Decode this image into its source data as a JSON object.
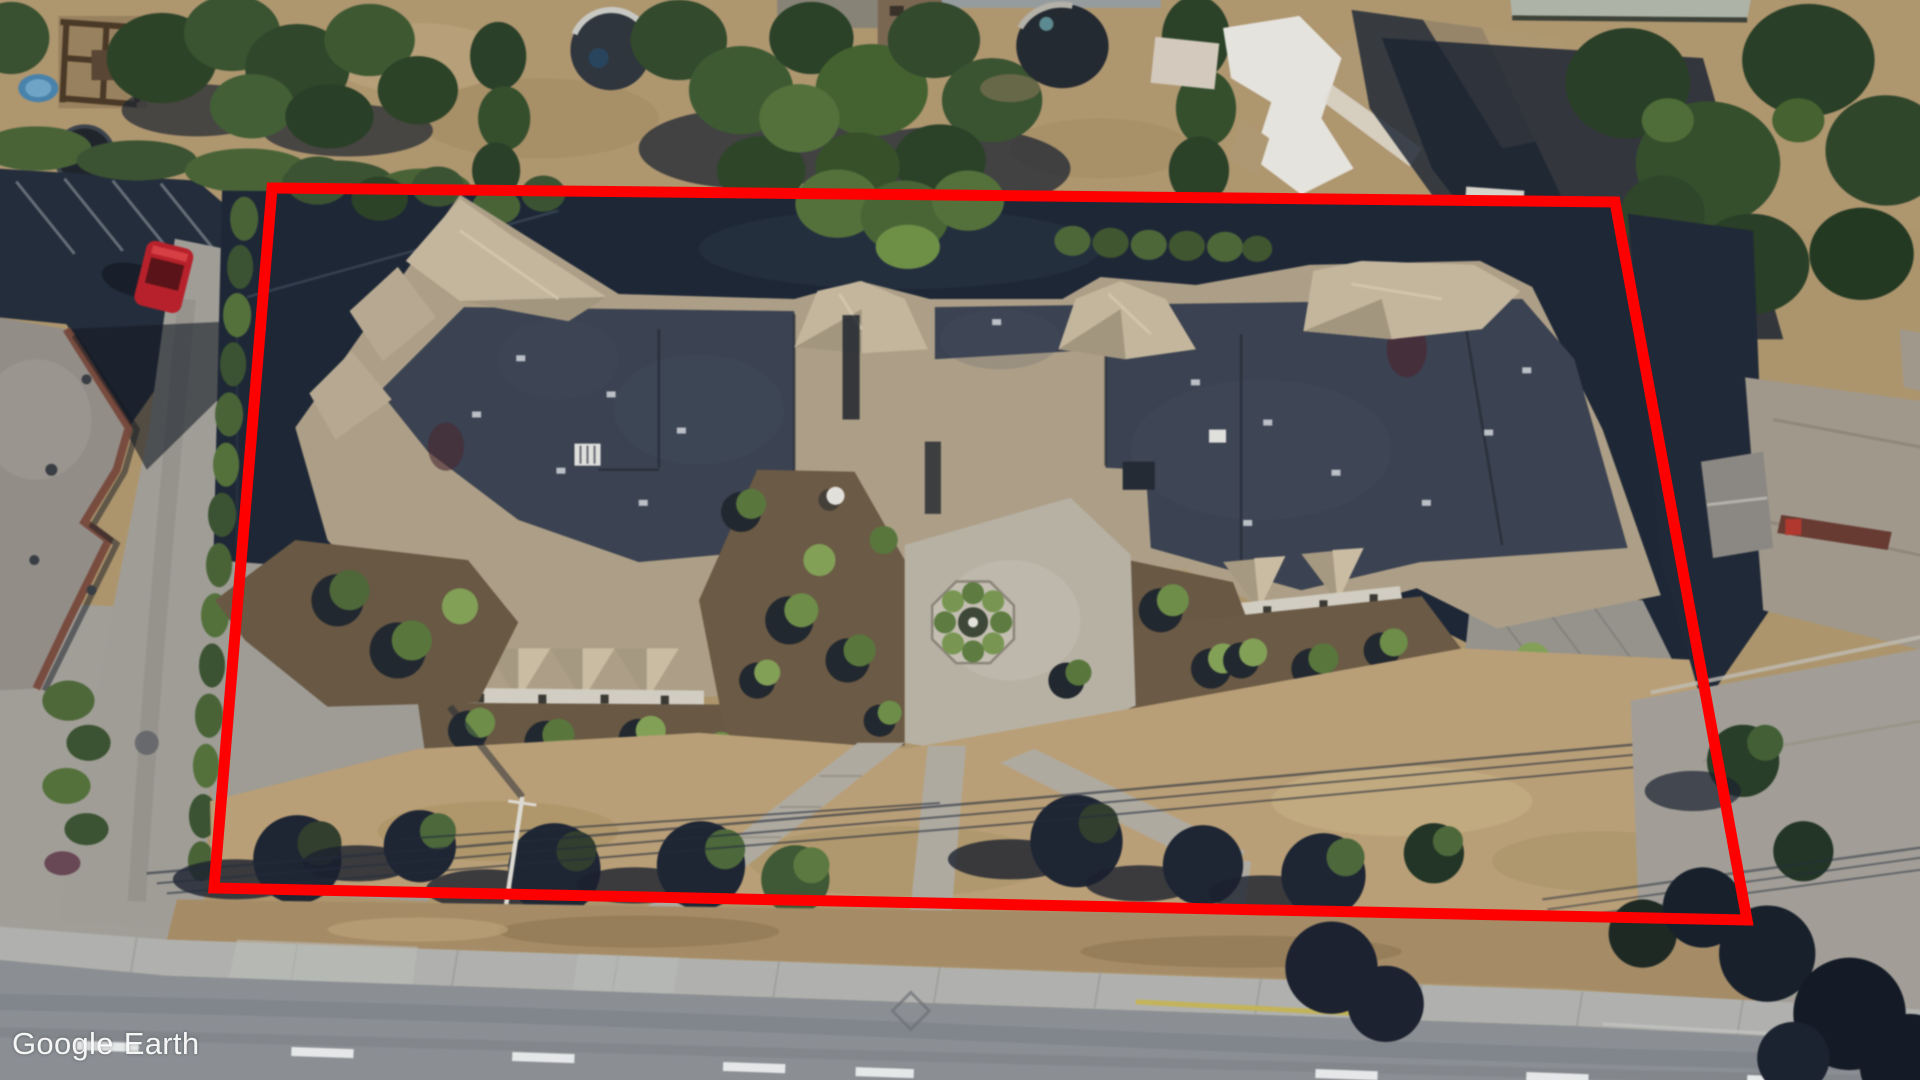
{
  "watermark": {
    "brand": "Google",
    "product": "Earth",
    "color": "#ffffff"
  },
  "boundary": {
    "points": "272,188 1615,202 1747,920 214,888",
    "color": "#fe0000",
    "stroke_width": "11"
  },
  "vehicles": {
    "red_car_color": "#c0212a"
  },
  "palette": {
    "asphalt_shadow": "#1e2836",
    "flat_roof": "#3c4452",
    "hip_roof_tan": "#c9bb9f",
    "dry_lawn": "#bfa478",
    "tree_green": "#31462c",
    "road_gray": "#8f9397",
    "lane_marking": "#ffffff",
    "curb_yellow": "#cdb94f"
  },
  "scene": {
    "type": "satellite-photo",
    "description": "Oblique aerial view of a large residential complex with dark flat roofs and tan hip roofs, landscaped entry courtyard, surrounded by parking areas, neighboring houses, trees and a street with dashed lane markings"
  }
}
